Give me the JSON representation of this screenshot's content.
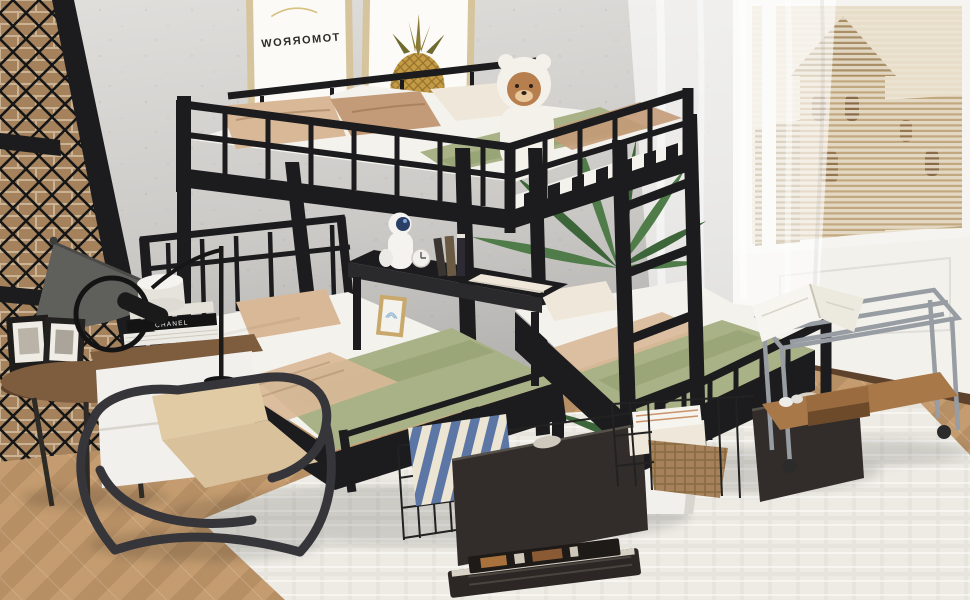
{
  "scene": {
    "title": "Black metal triple bunk bed — full over twin & twin with storage drawers",
    "setting": "Styled bedroom with concrete wall, brick-lattice accent wall, city-view window with blinds, sheer curtain, herringbone wood floor and white shag rug"
  },
  "posters": {
    "left_text": "TOMORROW",
    "left_note": "mirrored gold-framed print",
    "right_subject": "pineapple print"
  },
  "nightstand": {
    "book_spine_text": "CHANEL"
  },
  "objects": [
    "full-size top bunk with guardrails",
    "two twin lower beds",
    "integrated side ladder",
    "black metal shelf between twin beds",
    "astronaut figurine lamp",
    "alarm clock",
    "upright books",
    "teddy bear plush with white hood",
    "palm plant",
    "potted plant in white planter",
    "pull-out wire storage drawer with striped pillow",
    "pull-out wire storage drawer with towels and wicker basket",
    "cone floor lamp",
    "round wood side table with picture frames",
    "white nightstand with book stack and round speaker",
    "black swing-arm desk lamp",
    "bent-tube lounge chair",
    "chrome rolling cart with open book and radio",
    "books lying on rug",
    "mini framed rainbow print"
  ],
  "palette": {
    "wall": "#d7d5d2",
    "wallDeep": "#b3b1ae",
    "brick": "#a5825c",
    "mortar": "#c9b394",
    "metal": "#1c1c1e",
    "metalSoft": "#3a3a3e",
    "mattress": "#f4f2ed",
    "linen": "#e3dfd6",
    "green": "#a9b286",
    "greenDeep": "#8e9c6e",
    "tan": "#d9b897",
    "tanDeep": "#c49b78",
    "cream": "#efe8da",
    "drawer": "#322d2a",
    "rug": "#edebe4",
    "floor": "#c49c6f",
    "floorDeep": "#ab845c",
    "sky": "#ece4d2",
    "building": "#c2a87e",
    "buildingDeep": "#a98e66",
    "blind": "#e6ddc9",
    "leaf": "#4f7c49",
    "leafDeep": "#3c6539",
    "wood": "#7e5c3e",
    "woodDeep": "#5e422c",
    "chairSeat": "#d9c29b",
    "chairFrame": "#35353a",
    "cartMetal": "#979da2",
    "potWhite": "#f2f0ec",
    "stripeBlue": "#5c76a6",
    "stripeCream": "#ece5d4",
    "bearFace": "#b87f4e",
    "frameGold": "#d6c49c"
  }
}
